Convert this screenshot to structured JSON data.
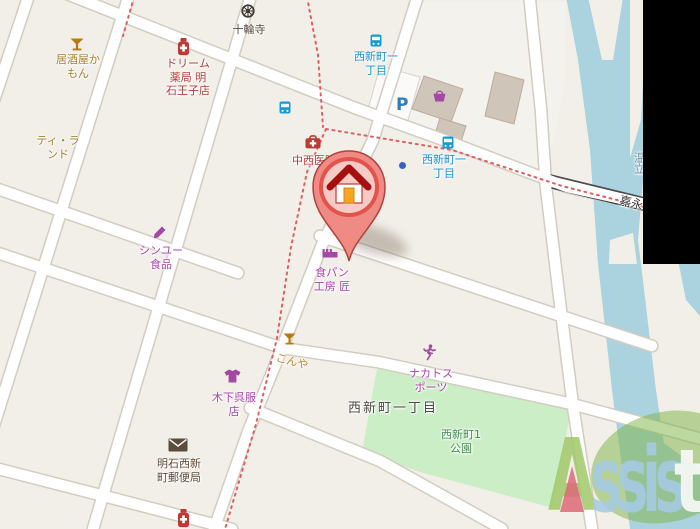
{
  "pois": {
    "izakaya": {
      "line1": "居酒屋か",
      "line2": "もん"
    },
    "tea_land": {
      "line1": "ティ・ラ",
      "line2": "ンド"
    },
    "pharmacy_dream": {
      "line1": "ドリーム",
      "line2": "薬局 明",
      "line3": "石王子店"
    },
    "temple": {
      "line1": "十輪寺"
    },
    "bus_stop_1": {
      "line1": "西新町一",
      "line2": "丁目"
    },
    "clinic": {
      "line1": "中西医院"
    },
    "bus_stop_2": {
      "line1": "西新町一",
      "line2": "丁目"
    },
    "shinyu": {
      "line1": "シンユー",
      "line2": "食品"
    },
    "bakery": {
      "line1": "食パン",
      "line2": "工房 匠"
    },
    "konya": {
      "line1": "こんや"
    },
    "kimono": {
      "line1": "木下呉服",
      "line2": "店"
    },
    "post_office": {
      "line1": "明石西新",
      "line2": "町郵便局"
    },
    "sports": {
      "line1": "ナカトス",
      "line2": "ポーツ"
    },
    "district": {
      "line1": "西新町一丁目"
    },
    "park": {
      "line1": "西新町1",
      "line2": "公園"
    },
    "bridge_road": {
      "line1": "嘉永"
    },
    "river": {
      "line1": "温立"
    }
  },
  "parking": {
    "label": "P"
  },
  "watermark": {
    "a": "A",
    "ssis": "ssis",
    "t": "t"
  },
  "colors": {
    "land": "#f2efe9",
    "water": "#aad3df",
    "park_green": "#cbeec6",
    "pin_red": "#e2544b",
    "boundary_red": "#e06060",
    "transit_blue": "#169bd5",
    "shop_purple": "#a349a4",
    "health_red": "#bc3a34",
    "amenity_gold": "#a5802a",
    "watermark_green": "#80b448",
    "watermark_blue": "#a6c9e4"
  }
}
